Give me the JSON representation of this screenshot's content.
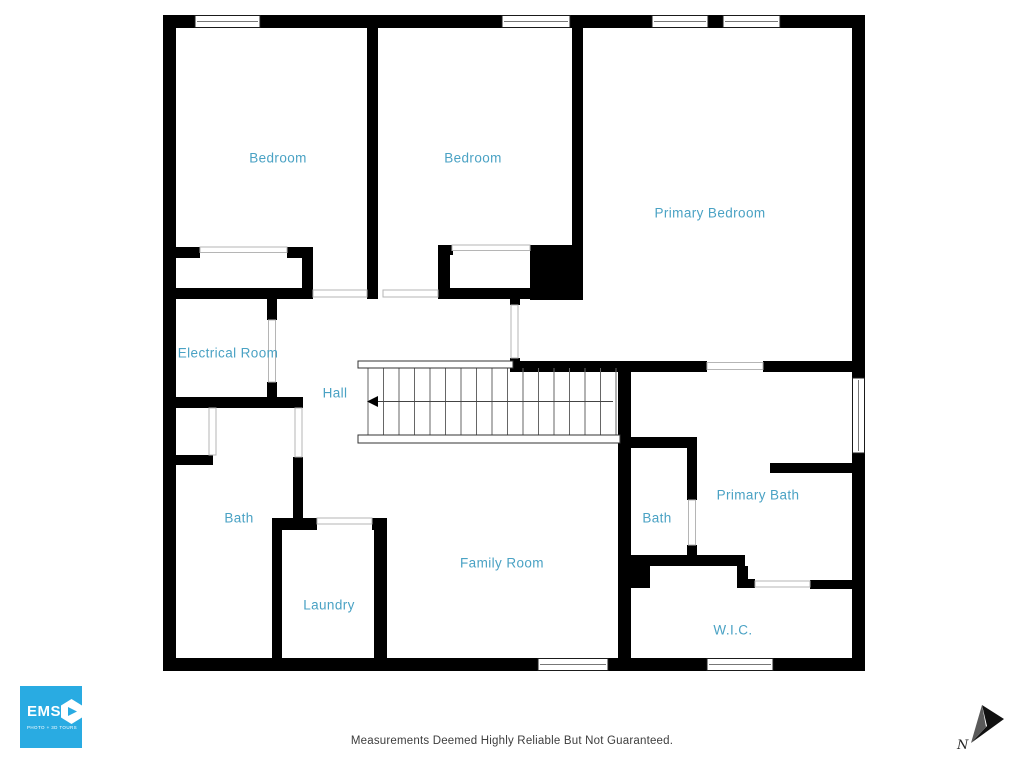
{
  "branding": {
    "logo_text": "EMS",
    "logo_subtext": "PHOTO + 3D TOURS",
    "logo_bg": "#29abe2"
  },
  "footer": {
    "disclaimer": "Measurements Deemed Highly Reliable But Not Guaranteed."
  },
  "compass": {
    "label": "N"
  },
  "colors": {
    "room_label": "#4aa2c4",
    "wall": "#000000"
  },
  "rooms": [
    {
      "id": "bedroom-1",
      "label": "Bedroom",
      "x": 278,
      "y": 158
    },
    {
      "id": "bedroom-2",
      "label": "Bedroom",
      "x": 473,
      "y": 158
    },
    {
      "id": "primary-bedroom",
      "label": "Primary Bedroom",
      "x": 710,
      "y": 213
    },
    {
      "id": "electrical-room",
      "label": "Electrical Room",
      "x": 228,
      "y": 353
    },
    {
      "id": "hall",
      "label": "Hall",
      "x": 335,
      "y": 393
    },
    {
      "id": "bath-left",
      "label": "Bath",
      "x": 239,
      "y": 518
    },
    {
      "id": "laundry",
      "label": "Laundry",
      "x": 329,
      "y": 605
    },
    {
      "id": "family-room",
      "label": "Family Room",
      "x": 502,
      "y": 563
    },
    {
      "id": "bath-right",
      "label": "Bath",
      "x": 657,
      "y": 518
    },
    {
      "id": "primary-bath",
      "label": "Primary Bath",
      "x": 758,
      "y": 495
    },
    {
      "id": "wic",
      "label": "W.I.C.",
      "x": 733,
      "y": 630
    }
  ],
  "stairs": {
    "tread_count": 17,
    "direction": "left"
  }
}
